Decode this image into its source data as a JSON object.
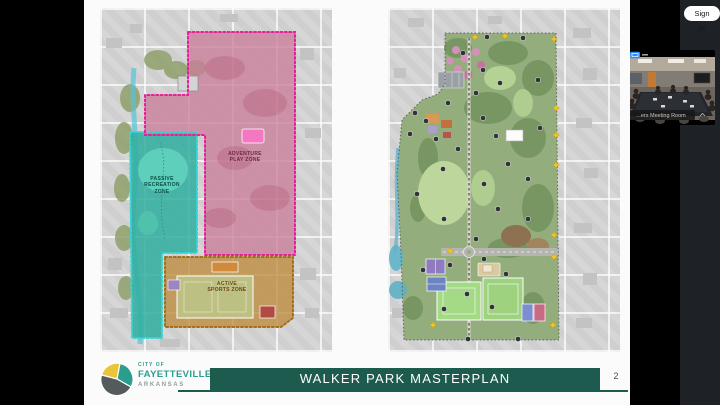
{
  "meeting": {
    "sign_in_label": "Sign in",
    "video": {
      "label": "...ers Meeting Room"
    }
  },
  "slide": {
    "banner_title": "WALKER PARK MASTERPLAN",
    "page_number": "2",
    "logo": {
      "tagline": "CITY OF",
      "city": "FAYETTEVILLE",
      "state": "ARKANSAS"
    }
  },
  "zoning_map": {
    "zones": [
      {
        "id": "adventure",
        "label": "ADVENTURE\nPLAY ZONE",
        "fill": "#c97d98",
        "border": "#e61f9b"
      },
      {
        "id": "passive",
        "label": "PASSIVE\nRECREATION\nZONE",
        "fill": "#2fae9f",
        "border": "#35d6d6"
      },
      {
        "id": "active",
        "label": "ACTIVE\nSPORTS ZONE",
        "fill": "#bf8a3d",
        "border": "#a2701c"
      }
    ]
  },
  "colors": {
    "banner_teal": "#1c5b4e",
    "logo_teal": "#2a9d8f",
    "logo_yellow": "#e9c53a",
    "logo_gray": "#555a5c",
    "sidebar_bg": "#1e2126",
    "star_yellow": "#f2c51d",
    "zoom_blue": "#2d8cff"
  }
}
